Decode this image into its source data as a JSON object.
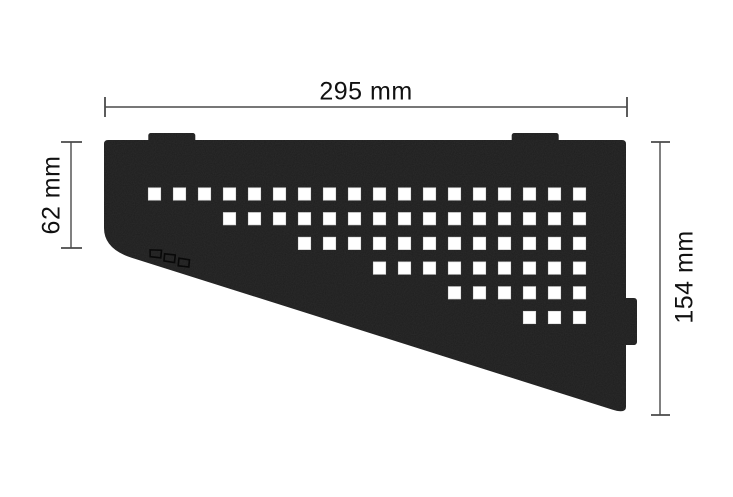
{
  "diagram": {
    "type": "technical-drawing",
    "subject": "quadrilateral corner shelf with square perforation pattern",
    "mounting_tabs_top": 2,
    "mounting_tab_side": 1
  },
  "colors": {
    "background": "#ffffff",
    "shelf": "#1d1d1d",
    "hole": "#ffffff",
    "hole_edge": "#d8d8d8",
    "dimension_line": "#4a4a4a",
    "label_text": "#111111"
  },
  "dimensions": {
    "width": {
      "label": "295 mm"
    },
    "left_height": {
      "label": "62 mm"
    },
    "right_height": {
      "label": "154 mm"
    }
  },
  "perforation_grid": {
    "square_size": 12.4,
    "pitch_x": 25,
    "pitch_y": 24.7,
    "origin_x": 154.5,
    "origin_y": 194,
    "total_columns": 18,
    "rows": [
      {
        "row": 1,
        "start_col": 1,
        "end_col": 18
      },
      {
        "row": 2,
        "start_col": 4,
        "end_col": 18
      },
      {
        "row": 3,
        "start_col": 7,
        "end_col": 18
      },
      {
        "row": 4,
        "start_col": 10,
        "end_col": 18
      },
      {
        "row": 5,
        "start_col": 13,
        "end_col": 18
      },
      {
        "row": 6,
        "start_col": 16,
        "end_col": 18
      }
    ]
  },
  "logo": {
    "name": "schluter-logo",
    "mark_count": 3
  }
}
